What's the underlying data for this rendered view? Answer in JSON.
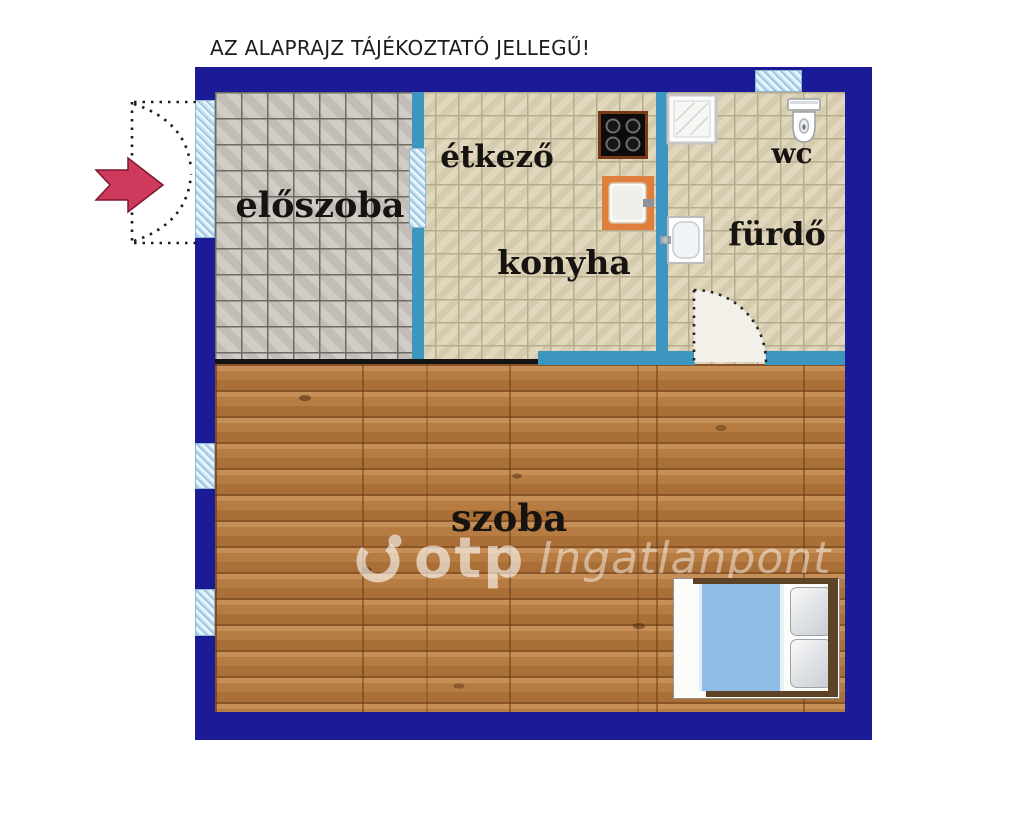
{
  "title": "AZ ALAPRAJZ TÁJÉKOZTATÓ JELLEGŰ!",
  "rooms": {
    "eloszoba": {
      "label": "előszoba"
    },
    "etkezo": {
      "label": "étkező"
    },
    "konyha": {
      "label": "konyha"
    },
    "wc": {
      "label": "wc"
    },
    "furdo": {
      "label": "fürdő"
    },
    "szoba": {
      "label": "szoba"
    }
  },
  "watermark": {
    "logo": "otp-spiral-logo",
    "brand": "otp",
    "name": "Ingatlanpont"
  },
  "fixtures": [
    "entrance-arrow-icon",
    "entrance-swing-icon",
    "entry-door-icon",
    "window-icon",
    "stove-icon",
    "sink-icon",
    "shower-icon",
    "toilet-icon",
    "washbasin-icon",
    "bathroom-door-swing-icon",
    "bed-icon"
  ],
  "colors": {
    "wall_navy": "#1b1b97",
    "wall_teal": "#3d96c0",
    "glass_blue": "#bcd9ec",
    "tile_gray": "#cac5be",
    "tile_beige": "#dcd3b6",
    "wood_brown": "#b1763c",
    "arrow_red": "#cf3a5c",
    "blanket_blue": "#8fbde6",
    "sink_orange": "#de7f3e"
  }
}
